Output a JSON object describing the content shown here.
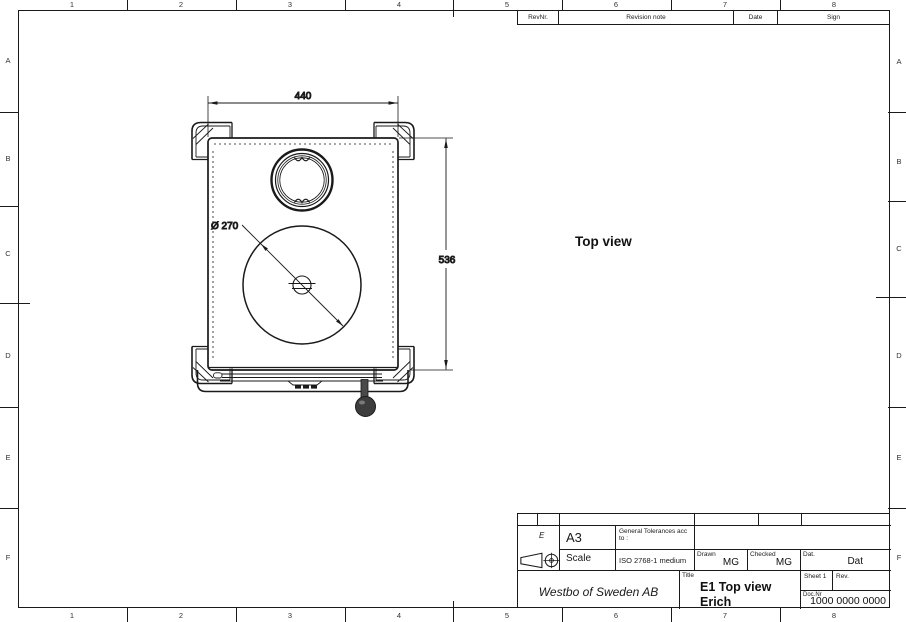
{
  "grid": {
    "columns": [
      "1",
      "2",
      "3",
      "4",
      "5",
      "6",
      "7",
      "8"
    ],
    "rows": [
      "A",
      "B",
      "C",
      "D",
      "E",
      "F"
    ]
  },
  "revision_table": {
    "rev_nr_label": "RevNr.",
    "note_label": "Revision note",
    "date_label": "Date",
    "sign_label": "Sign"
  },
  "drawing": {
    "view_label": "Top view",
    "width_dim": "440",
    "depth_dim": "536",
    "diameter_dim": "Ø 270"
  },
  "title_block": {
    "zone_label": "E",
    "paper_size": "A3",
    "scale_label": "Scale",
    "tolerance_label": "General Tolerances acc to :",
    "tolerance_value": "ISO 2768-1 medium",
    "drawn_label": "Drawn",
    "drawn_value": "MG",
    "checked_label": "Checked",
    "checked_value": "MG",
    "date_label": "Dat.",
    "date_value": "Dat",
    "company": "Westbo of Sweden AB",
    "title_label": "Title",
    "title_line1": "E1 Top view",
    "title_line2": "Erich",
    "sheet_label": "Sheet 1",
    "rev_label": "Rev.",
    "docnr_label": "Doc.Nr",
    "docnr_value": "1000 0000 0000",
    "projection_symbol": "first-angle-projection"
  },
  "colors": {
    "line": "#1a1a1a",
    "background": "#ffffff"
  }
}
